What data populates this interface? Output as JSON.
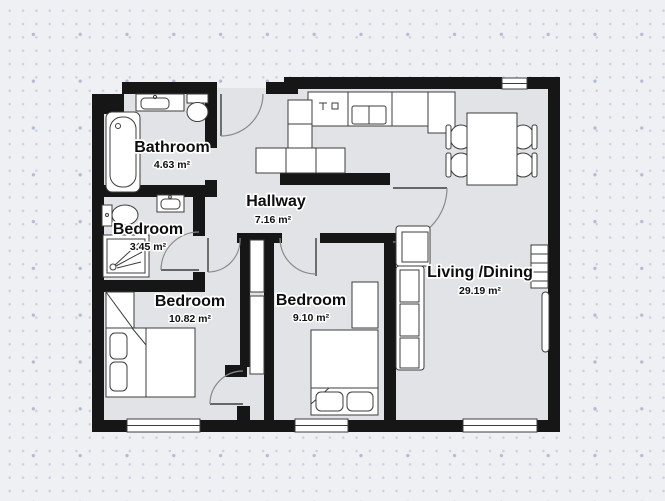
{
  "plan": {
    "rooms": [
      {
        "id": "bathroom",
        "name": "Bathroom",
        "area": "4.63 m²"
      },
      {
        "id": "bedroom-ensuite",
        "name": "Bedroom",
        "area": "3.45 m²"
      },
      {
        "id": "hallway",
        "name": "Hallway",
        "area": "7.16 m²"
      },
      {
        "id": "bedroom-left",
        "name": "Bedroom",
        "area": "10.82 m²"
      },
      {
        "id": "bedroom-middle",
        "name": "Bedroom",
        "area": "9.10 m²"
      },
      {
        "id": "living-dining",
        "name": "Living /Dining",
        "area": "29.19 m²"
      }
    ],
    "colors": {
      "wall": "#161616",
      "floor": "#e2e3e6",
      "background": "#eef0f3",
      "fixture_fill": "#ffffff",
      "fixture_stroke": "#3c3c3c",
      "dot_small": "#ccd1df",
      "dot_large": "#b4bcd3"
    }
  }
}
